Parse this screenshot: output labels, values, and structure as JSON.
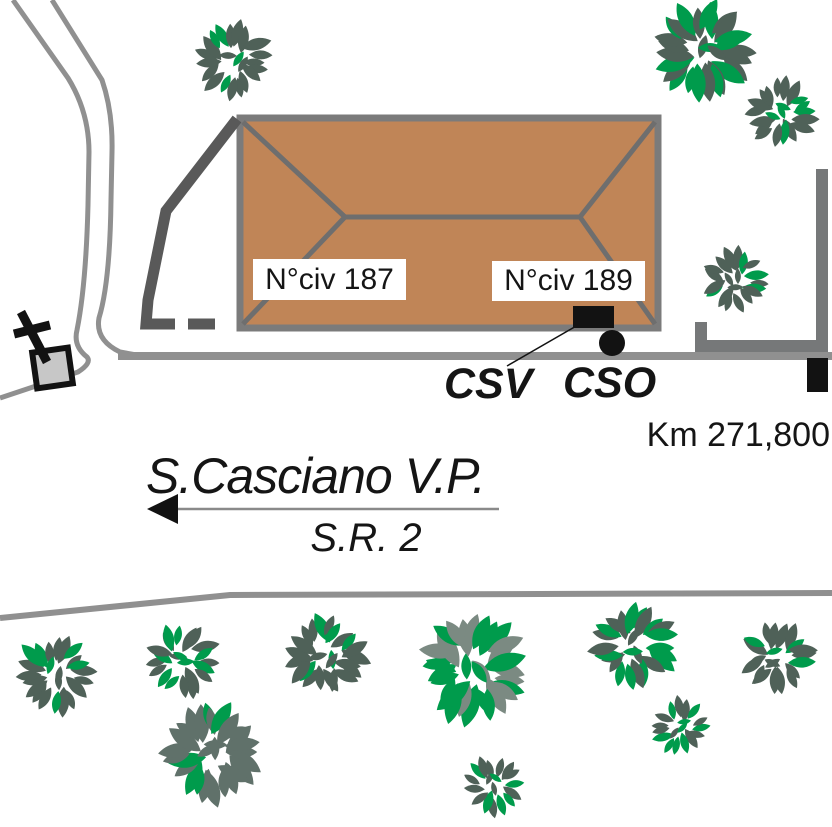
{
  "labels": {
    "civ187": "N°civ 187",
    "civ189": "N°civ 189",
    "csv": "CSV",
    "cso": "CSO",
    "km": "Km 271,800",
    "destination": "S.Casciano V.P.",
    "road_name": "S.R. 2"
  },
  "colors": {
    "building_fill": "#c08557",
    "building_outline": "#7b7b7b",
    "roof_line": "#6e6e6e",
    "wall": "#595959",
    "road": "#909090",
    "enclosure": "#767879",
    "ink": "#121212",
    "chapel_fill": "#c7c7c7",
    "tree_slate": "#4f6158",
    "tree_green": "#009b4c"
  },
  "markers": {
    "csv_rect": {
      "x": 573,
      "y": 306,
      "w": 41,
      "h": 22
    },
    "cso_circle": {
      "cx": 612,
      "cy": 343,
      "r": 13
    },
    "km_post": {
      "x": 807,
      "y": 358,
      "w": 21,
      "h": 34
    }
  },
  "trees": [
    {
      "x": 233,
      "y": 61,
      "r": 40,
      "green": 0.32
    },
    {
      "x": 703,
      "y": 51,
      "r": 53,
      "green": 0.38
    },
    {
      "x": 780,
      "y": 113,
      "r": 37,
      "green": 0.3
    },
    {
      "x": 735,
      "y": 280,
      "r": 35,
      "green": 0.3
    },
    {
      "x": 56,
      "y": 674,
      "r": 41,
      "green": 0.28
    },
    {
      "x": 183,
      "y": 661,
      "r": 39,
      "green": 0.3
    },
    {
      "x": 326,
      "y": 656,
      "r": 43,
      "green": 0.3
    },
    {
      "x": 473,
      "y": 668,
      "r": 58,
      "green": 0.52,
      "slate": "#7b8a82"
    },
    {
      "x": 213,
      "y": 752,
      "r": 52,
      "green": 0.45,
      "slate": "#60716a"
    },
    {
      "x": 634,
      "y": 646,
      "r": 45,
      "green": 0.42
    },
    {
      "x": 777,
      "y": 657,
      "r": 38,
      "green": 0.32
    },
    {
      "x": 680,
      "y": 727,
      "r": 31,
      "green": 0.25
    },
    {
      "x": 494,
      "y": 786,
      "r": 32,
      "green": 0.3
    }
  ]
}
